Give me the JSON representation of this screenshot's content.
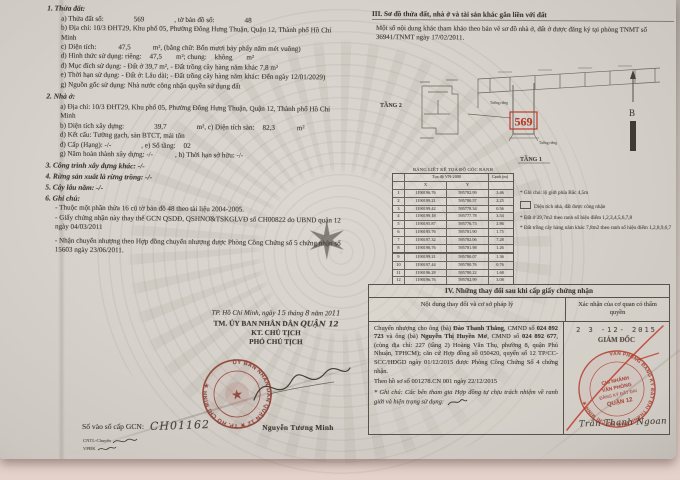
{
  "colors": {
    "paper": "#d8d4cd",
    "ink": "#3e3a34",
    "stamp_maroon": "#8f3a2f",
    "stamp_red": "#b03a2c",
    "bright_red": "#c03a2a"
  },
  "left": {
    "s1": {
      "heading": "1. Thửa đất:",
      "parcel_label": "a) Thửa đất số:",
      "parcel_number": "569",
      "map_label": ", tờ bản đồ số:",
      "map_number": "48",
      "address": "b) Địa chỉ: 10/3 ĐHT29, Khu phố 05, Phường Đông Hưng Thuận, Quận 12, Thành phố Hồ Chí Minh",
      "area_label": "c) Diện tích:",
      "area_value": "47,5",
      "area_text": "m², (bằng chữ: Bốn mươi bảy phẩy năm mét vuông)",
      "use_form": [
        "d) Hình thức sử dụng: riêng:",
        "47,5",
        "m²; chung:",
        "không",
        "m²"
      ],
      "purpose": "đ) Mục đích sử dụng: - Đất ở 39,7 m², - Đất trồng cây hàng năm khác 7,8 m²",
      "term": "e) Thời hạn sử dụng: - Đất ở: Lâu dài; - Đất trồng cây hàng năm khác: Đến ngày 12/01/2029)",
      "origin": "g) Nguồn gốc sử dụng: Nhà nước công nhận quyền sử dụng đất"
    },
    "s2": {
      "heading": "2. Nhà ở:",
      "address": "a) Địa chỉ: 10/3 ĐHT29, Khu phố 05, Phường Đông Hưng Thuận, Quận 12, Thành phố Hồ Chí Minh",
      "build_area": [
        "b) Diện tích xây dựng:",
        "39,7",
        "m², c) Diện tích sàn:",
        "82,3",
        "m²"
      ],
      "structure": "d) Kết cấu: Tường gạch, sàn BTCT, mái tôn",
      "grade": [
        "đ) Cấp (Hạng): -/-",
        ", e) Số tầng:",
        "02"
      ],
      "year_term": [
        "g) Năm hoàn thành xây dựng: -/-",
        ", h) Thời hạn sở hữu: -/-"
      ]
    },
    "s3": "3. Công trình xây dựng khác: -/-",
    "s4": "4. Rừng sản xuất là rừng trồng: -/-",
    "s5": "5. Cây lâu năm: -/-",
    "s6": {
      "heading": "6. Ghi chú:",
      "notes": [
        "- Thuộc một phần thửa 16 cũ tờ bản đồ 48 theo tài liệu 2004-2005.",
        "- Giấy chứng nhận này thay thế GCN QSDĐ, QSHNƠ&TSKGLVĐ số CH00822 do UBND quận 12 ngày 04/03/2011",
        "- Nhận chuyển nhượng theo Hợp đồng chuyển nhượng được Phòng Công Chứng số 5 chứng nhận số 15603 ngày 23/06/2011."
      ]
    },
    "sign": {
      "place_line": [
        "TP. Hồ Chí Minh, ngày",
        "15",
        "tháng",
        "8",
        "năm 20",
        "11"
      ],
      "org": "TM. ỦY BAN NHÂN DÂN",
      "org_hand": "QUẬN 12",
      "kt": "KT. CHỦ TỊCH",
      "deputy": "PHÓ CHỦ TỊCH",
      "signer": "Nguyễn Tương Minh",
      "stamp_ring": "ỦY BAN NHÂN DÂN QUẬN 12 ★ TP. HỒ CHÍ MINH ★",
      "reg_label": "Số vào sổ cấp GCN:",
      "reg_value": "CH01162",
      "clerk1": "CNTL-Chuyển",
      "clerk2": "VPĐK"
    }
  },
  "right": {
    "s3_heading": "III. Sơ đồ thửa đất, nhà ở và tài sản khác gắn liền với đất",
    "s3_note": "Một số nội dung khác tham khảo theo bản vẽ sơ đồ nhà ở, đất ở được đăng ký tại phòng TNMT số 36941/TNMT ngày 17/02/2011.",
    "diagram": {
      "floor2_label": "TẦNG 2",
      "floor1_label": "TẦNG 1",
      "parcel_number": "569",
      "north_label": "B",
      "wall_label_left": "Tường riêng",
      "wall_label_right": "Tường riêng"
    },
    "coord_table": {
      "title": "BẢNG LIỆT KÊ TỌA ĐỘ GÓC RANH",
      "group_header": "Tọa độ VN-2000",
      "col_x": "X",
      "col_y": "Y",
      "col_edge": "Cạnh (m)",
      "rows": [
        [
          "1",
          "1190196.76",
          "595782.99",
          "3.46"
        ],
        [
          "2",
          "1190199.21",
          "595780.57",
          "2.25"
        ],
        [
          "3",
          "1190199.42",
          "595778.34",
          "0.56"
        ],
        [
          "4",
          "1190199.18",
          "595777.78",
          "3.54"
        ],
        [
          "5",
          "1190195.87",
          "595776.73",
          "2.86"
        ],
        [
          "6",
          "1190195.76",
          "595781.90",
          "1.75"
        ],
        [
          "7",
          "1190197.32",
          "595782.06",
          "7.28"
        ],
        [
          "8",
          "1190196.76",
          "595781.98",
          "1.26"
        ],
        [
          "9",
          "1190199.21",
          "595780.07",
          "1.36"
        ],
        [
          "10",
          "1190197.44",
          "595780.76",
          "0.76"
        ],
        [
          "11",
          "1190196.28",
          "595780.22",
          "1.68"
        ],
        [
          "12",
          "1190196.76",
          "595782.99",
          "3.08"
        ]
      ]
    },
    "notes": [
      "* Ghi chú: lộ giới phía Bắc 4,5m",
      "Diện tích nhà, đất được công nhận",
      "* Đất ở 39,7m2 theo ranh số hiệu điểm 1,2,3,4,5,6,7,8",
      "* Đất trồng cây hàng năm khác 7,8m2 theo ranh số hiệu điểm 1,2,8,9,6,7"
    ],
    "s4": {
      "heading": "IV. Những thay đổi sau khi cấp giấy chứng nhận",
      "col_content": "Nội dung thay đổi và cơ sở pháp lý",
      "col_confirm": "Xác nhận của cơ quan có thẩm quyền",
      "p1": [
        "Chuyển nhượng cho ông (bà) ",
        "Đào Thanh Thắng",
        ", CMND số ",
        "024 892 723",
        " và ông (bà) ",
        "Nguyễn Thị Huyền Mơ",
        ", CMND số ",
        "024 892 677",
        ", (cùng địa chỉ: 227 (tầng 2) Hoàng Văn Thụ, phường 8, quận Phú Nhuận, TPHCM); căn cứ Hợp đồng số 050420, quyển số 12 TP/CC-SCC/HĐGD ngày 01/12/2015 được Phòng Công Chứng Số 4 chứng nhận."
      ],
      "p2": "Theo hồ sơ số 001278.CN 001 ngày 22/12/2015",
      "p3": "* Ghi chú: Các bên tham gia Hợp đồng tự chịu trách nhiệm về ranh giới và hiện trạng sử dụng:",
      "date_stamp": "2 3 -12- 2015",
      "director": "GIÁM ĐỐC",
      "signer": "Trần Thanh Ngoan",
      "stamp_ring": "VĂN PHÒNG ĐĂNG KÝ ĐẤT ĐAI THÀNH PHỐ HỒ CHÍ MINH ★",
      "stamp_center": [
        "CHI NHÁNH",
        "VĂN PHÒNG",
        "ĐĂNG KÝ ĐẤT ĐAI",
        "QUẬN 12"
      ]
    }
  }
}
